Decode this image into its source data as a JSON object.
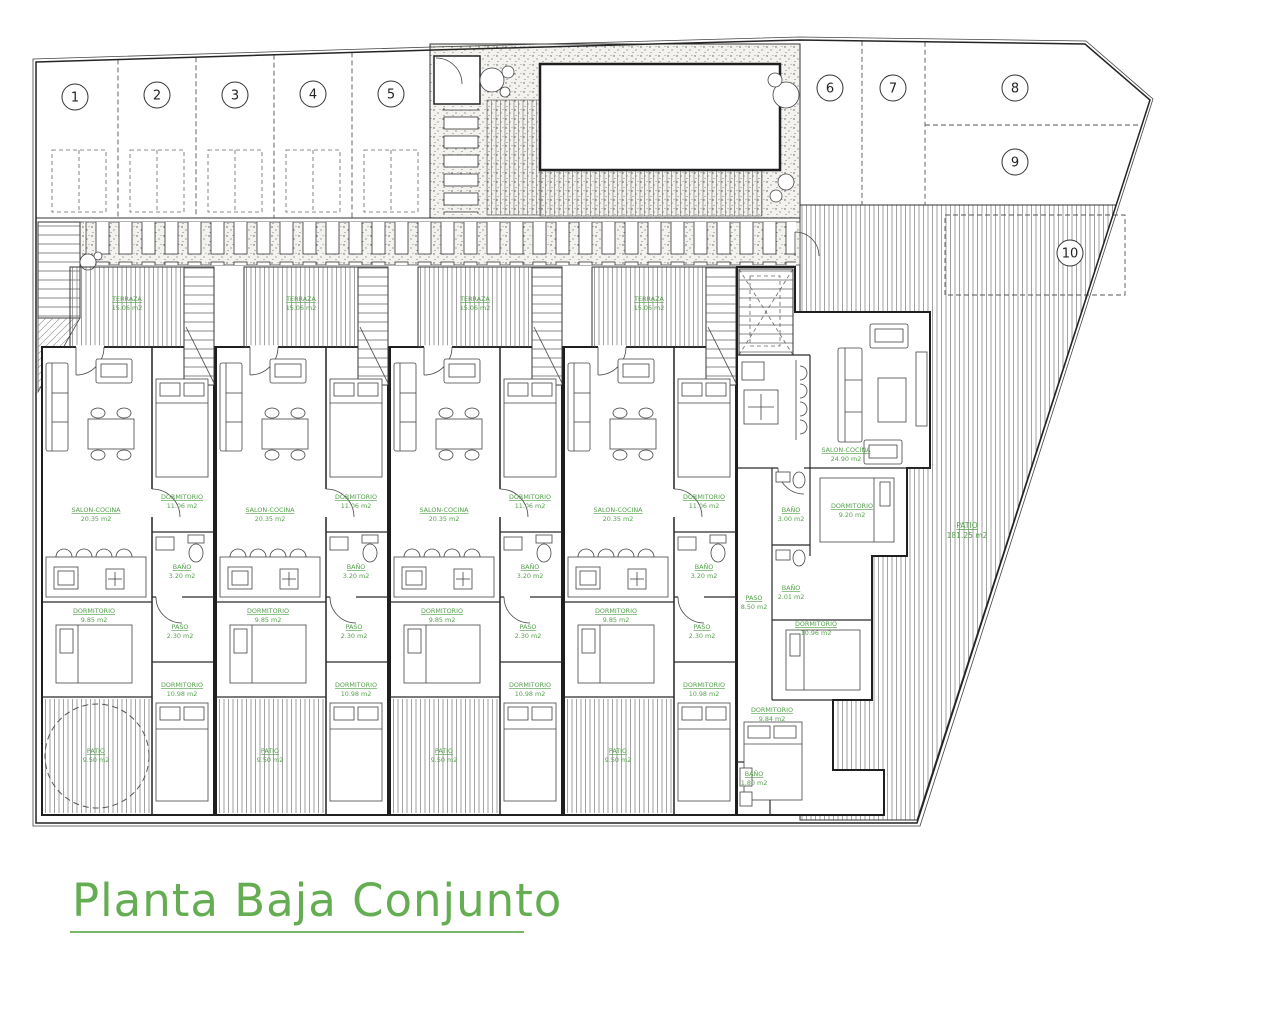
{
  "title": {
    "text": "Planta Baja Conjunto"
  },
  "colors": {
    "accent_green": "#55a04c",
    "line": "#222222"
  },
  "plots": [
    "1",
    "2",
    "3",
    "4",
    "5",
    "6",
    "7",
    "8",
    "9",
    "10"
  ],
  "module_rooms": {
    "terraza": {
      "name": "TERRAZA",
      "area": "15.06 m2"
    },
    "salon": {
      "name": "SALON-COCINA",
      "area": "20.35 m2"
    },
    "dorm1": {
      "name": "DORMITORIO",
      "area": "11.06 m2"
    },
    "bano": {
      "name": "BAÑO",
      "area": "3.20 m2"
    },
    "paso": {
      "name": "PASO",
      "area": "2.30 m2"
    },
    "dorm2": {
      "name": "DORMITORIO",
      "area": "10.98 m2"
    },
    "dorm3": {
      "name": "DORMITORIO",
      "area": "9.85 m2"
    },
    "patio": {
      "name": "PATIO",
      "area": "9.50 m2"
    }
  },
  "end_unit": {
    "salon": {
      "name": "SALON-COCINA",
      "area": "24.90 m2"
    },
    "dorm_a": {
      "name": "DORMITORIO",
      "area": "9.20 m2"
    },
    "dorm_b": {
      "name": "DORMITORIO",
      "area": "10.96 m2"
    },
    "dorm_c": {
      "name": "DORMITORIO",
      "area": "9.84 m2"
    },
    "bano_1": {
      "name": "BAÑO",
      "area": "3.00 m2"
    },
    "bano_2": {
      "name": "BAÑO",
      "area": "2.01 m2"
    },
    "bano_3": {
      "name": "BAÑO",
      "area": "1.80 m2"
    },
    "paso": {
      "name": "PASO",
      "area": "8.50 m2"
    },
    "garden": {
      "name": "PATIO",
      "area": "181.25 m2"
    }
  }
}
